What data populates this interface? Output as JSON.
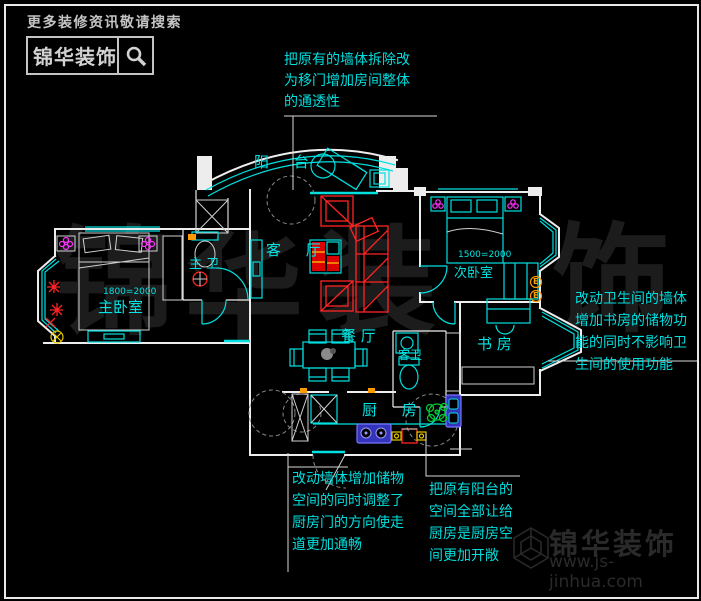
{
  "branding": {
    "search_hint": "更多装修资讯敬请搜索",
    "name": "锦华装饰",
    "website": "www.js-jinhua.com",
    "watermark_chars": [
      "锦",
      "华",
      "装",
      "饰"
    ]
  },
  "rooms": {
    "balcony": "阳 台",
    "master_bedroom": "主卧室",
    "master_bath": "主 卫",
    "living": "客 厅",
    "dining": "餐 厅",
    "second_bedroom": "次卧室",
    "study": "书 房",
    "guest_bath": "客卫",
    "kitchen": "厨 房"
  },
  "dimensions": {
    "master_bed": "1800=2000",
    "second_bed": "1500=2000"
  },
  "annotations": {
    "top": "把原有的墙体拆除改\n为移门增加房间整体\n的通透性",
    "right": "改动卫生间的墙体\n增加书房的储物功\n能的同时不影响卫\n生间的使用功能",
    "bottom_left": "改动墙体增加储物\n空间的同时调整了\n厨房门的方向使走\n道更加通畅",
    "bottom_center": "把原有阳台的\n空间全部让给\n厨房是厨房空\n间更加开敞"
  },
  "symbols": {
    "outlet_label": "E"
  },
  "colors": {
    "line_cyan": "#00e0e0",
    "wall_white": "#ededed",
    "accent_red": "#ff2424",
    "accent_magenta": "#ff30ff",
    "accent_blue": "#3434bb",
    "accent_green": "#00cc33",
    "accent_orange": "#ff9900",
    "watermark_gray": "#1c1c1c"
  }
}
